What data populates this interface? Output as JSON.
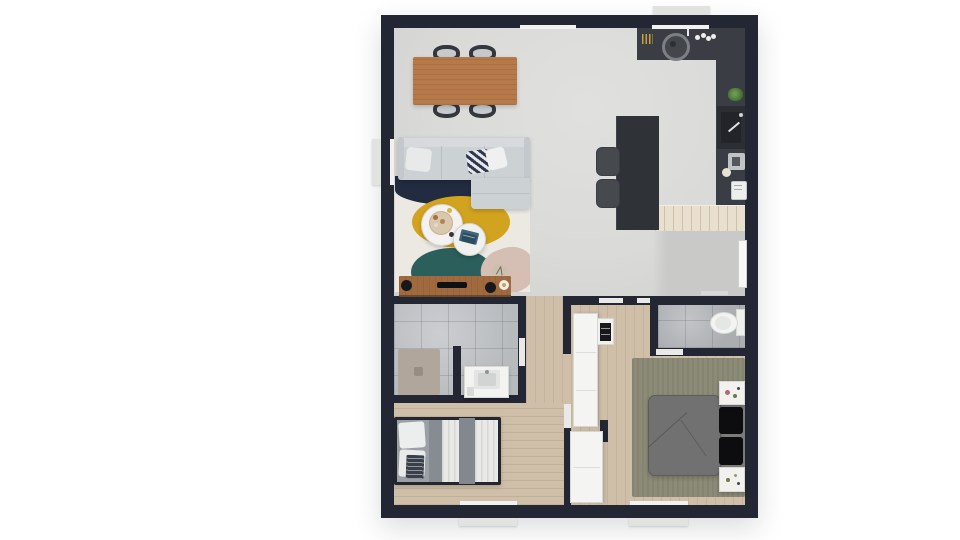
{
  "scene": {
    "type": "floor-plan-3d-top-view",
    "background": "#ffffff",
    "rooms": [
      {
        "id": "living-dining-kitchen"
      },
      {
        "id": "entry"
      },
      {
        "id": "bathroom"
      },
      {
        "id": "wc"
      },
      {
        "id": "hallway"
      },
      {
        "id": "bedroom-small"
      },
      {
        "id": "bedroom-master"
      }
    ],
    "furniture": [
      {
        "id": "dining-table"
      },
      {
        "id": "dining-chair",
        "count": 4
      },
      {
        "id": "sectional-sofa"
      },
      {
        "id": "throw-pillow",
        "count": 3
      },
      {
        "id": "area-rug-abstract"
      },
      {
        "id": "coffee-table-round-large"
      },
      {
        "id": "coffee-table-round-small"
      },
      {
        "id": "tv-console"
      },
      {
        "id": "tv"
      },
      {
        "id": "speaker",
        "count": 2
      },
      {
        "id": "kitchen-counter-l-shape"
      },
      {
        "id": "kitchen-island"
      },
      {
        "id": "bar-stool",
        "count": 2
      },
      {
        "id": "kitchen-sink-round"
      },
      {
        "id": "kitchen-sink-inset"
      },
      {
        "id": "coffee-machine"
      },
      {
        "id": "toaster"
      },
      {
        "id": "plant",
        "count": 2
      },
      {
        "id": "wood-counter"
      },
      {
        "id": "shower-mat"
      },
      {
        "id": "sink-vanity"
      },
      {
        "id": "toilet"
      },
      {
        "id": "wardrobe",
        "count": 2
      },
      {
        "id": "hall-shelf"
      },
      {
        "id": "single-bed"
      },
      {
        "id": "double-bed"
      },
      {
        "id": "nightstand",
        "count": 2
      },
      {
        "id": "black-pillow",
        "count": 2
      }
    ],
    "openings": {
      "windows": 5,
      "door_marks": 7,
      "front_door": 1
    }
  },
  "palette": {
    "background": "#ffffff",
    "wall": "#232734",
    "living_floor": "#dadad8",
    "entry_floor": "#c9cac8",
    "wood_floor": "#cfbfa9",
    "bath_tile": "#b8bbbe",
    "wc_tile": "#abaeb1",
    "shower_mat": "#b1a69c",
    "counter_dark": "#3a3e44",
    "island_dark": "#2f3237",
    "counter_wood": "#e9dfce",
    "stool_gray": "#46494e",
    "dining_table_wood": "#b5794a",
    "chair_dark": "#34373c",
    "sofa_gray": "#ccd1d4",
    "rug_cream": "#ece9e3",
    "rug_navy": "#222b40",
    "rug_mustard": "#d2a31e",
    "rug_teal": "#2b5f5b",
    "rug_blush": "#d5beb4",
    "tv_console_wood": "#a06a3e",
    "speaker_black": "#17181c",
    "wardrobe_white": "#f4f4f2",
    "bed2_frame": "#23262f",
    "bed2_gray": "#878c92",
    "bed2_band": "#83888e",
    "bed2_duvet": "#e9e9e7",
    "master_rug_olive": "#8c8b77",
    "master_duvet_gray": "#707170",
    "master_mattress": "#7b7c79",
    "pillow_black": "#0d0d0f",
    "nightstand_white": "#f2f1ee",
    "fixture_white": "#f3f4f2",
    "plant_green": "#4e7a3a",
    "door_white": "#f7f7f5",
    "window_frame": "#f1f1f0"
  }
}
